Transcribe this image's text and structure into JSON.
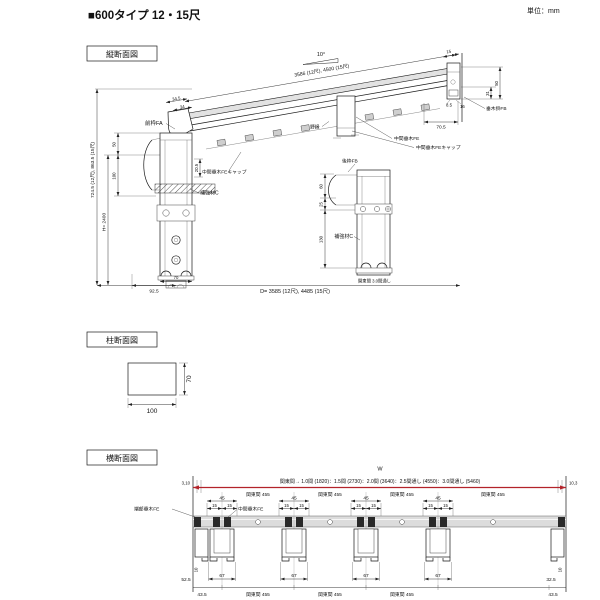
{
  "page": {
    "title": "■600タイプ 12・15尺",
    "unit": "単位：mm"
  },
  "sections": {
    "vertical": "縦断面図",
    "column": "柱断面図",
    "horizontal": "横断面図"
  },
  "vs": {
    "angle": "10°",
    "slope_dim": "3586 (12尺), 4500 (15尺)",
    "total_height": "724.5 (12尺), 863.5 (15尺)",
    "post_height": "H= 2400",
    "d34_5": "34.5",
    "d34": "34",
    "front_frame": "前枠FA",
    "nobuchi": "野縁",
    "d50_left": "50",
    "d100": "100",
    "d20_5": "20.5",
    "reinforcement": "補強材C",
    "cap": "中間垂木FEキャップ",
    "mid_rafter": "中間垂木FE",
    "rear_frame": "後枠FB",
    "hanger": "垂木掛FB",
    "d15": "15",
    "d50_right": "50",
    "d31": "31",
    "d8_5": "8.5",
    "d16": "16",
    "d70_5": "70.5",
    "d60": "60",
    "d25": "25",
    "d130": "130",
    "note": "関東間 3.0間通し",
    "depth_dim": "D= 3585 (12尺), 4485 (15尺)",
    "d92_5": "92.5",
    "d70": "70"
  },
  "cs": {
    "w": "100",
    "h": "70"
  },
  "hs": {
    "w": "W",
    "span": "関東間→ 1.0間 (1820)：1.5間 (2730)：2.0間 (3640)：2.5間通し (4550)：3.0間通し (5460)",
    "bay": "関東間 455",
    "d45": "45",
    "d15": "15",
    "d67": "67",
    "edge_rafter": "端部垂木FE",
    "mid_rafter": "中間垂木FE",
    "tl": "3,10",
    "tr": "10,3",
    "d10": "10",
    "d52_5": "52.5",
    "d32_5": "32.5",
    "d43_5": "43.5"
  },
  "colors": {
    "accent_red": "#b3232a",
    "line": "#1a1a1a",
    "panel_gray": "#e0e0e0",
    "beam_gray": "#dcdcdc"
  }
}
